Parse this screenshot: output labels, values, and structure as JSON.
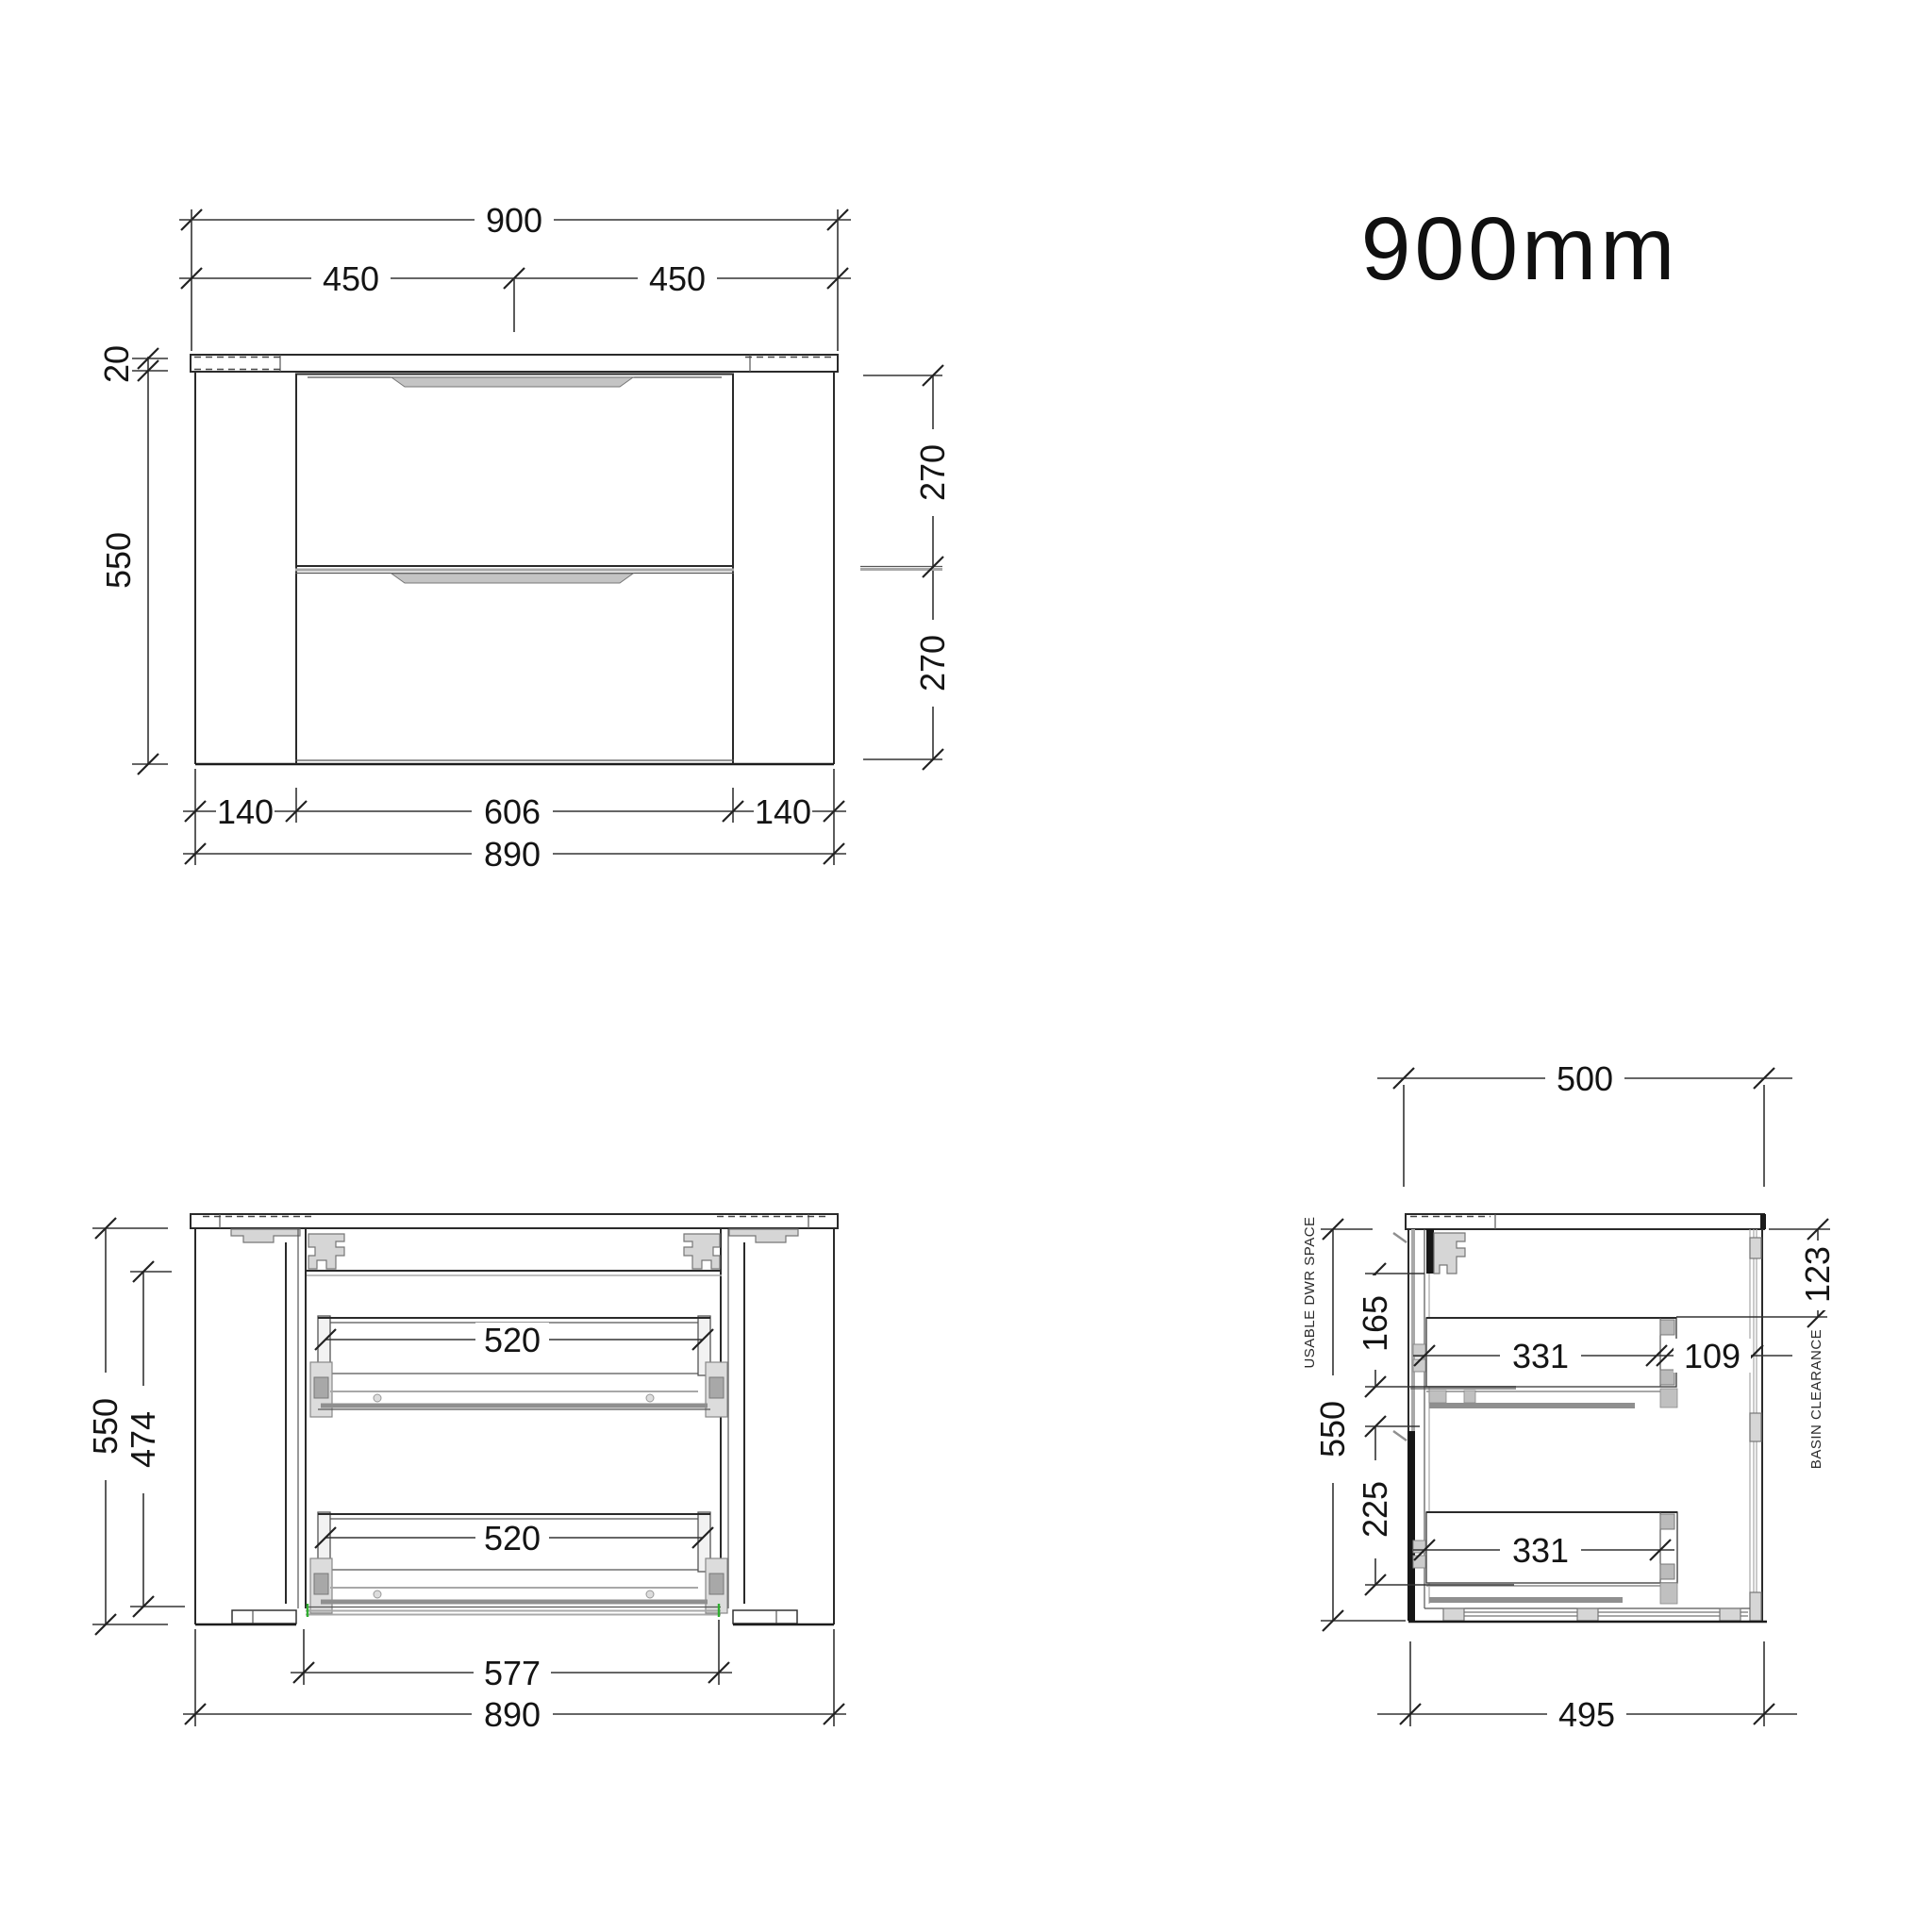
{
  "title": "900mm",
  "front_view": {
    "dims": {
      "overall_width": "900",
      "half_left": "450",
      "half_right": "450",
      "counter_thickness": "20",
      "overall_height": "550",
      "drawer_top_height": "270",
      "drawer_bottom_height": "270",
      "leg_left": "140",
      "drawer_width": "606",
      "leg_right": "140",
      "carcass_width": "890"
    }
  },
  "internal_view": {
    "dims": {
      "overall_height": "550",
      "internal_height": "474",
      "drawer_top_width": "520",
      "drawer_bottom_width": "520",
      "internal_width": "577",
      "carcass_width": "890"
    }
  },
  "side_view": {
    "annotations": {
      "usable_dwr_space": "USABLE DWR SPACE",
      "basin_clearance_label": "BASIN CLEARANCE"
    },
    "dims": {
      "overall_depth": "500",
      "basin_clearance": "123",
      "usable_top": "165",
      "overall_height": "550",
      "usable_bottom": "225",
      "drawer_top_depth": "331",
      "back_gap": "109",
      "drawer_bottom_depth": "331",
      "base_depth": "495"
    }
  }
}
